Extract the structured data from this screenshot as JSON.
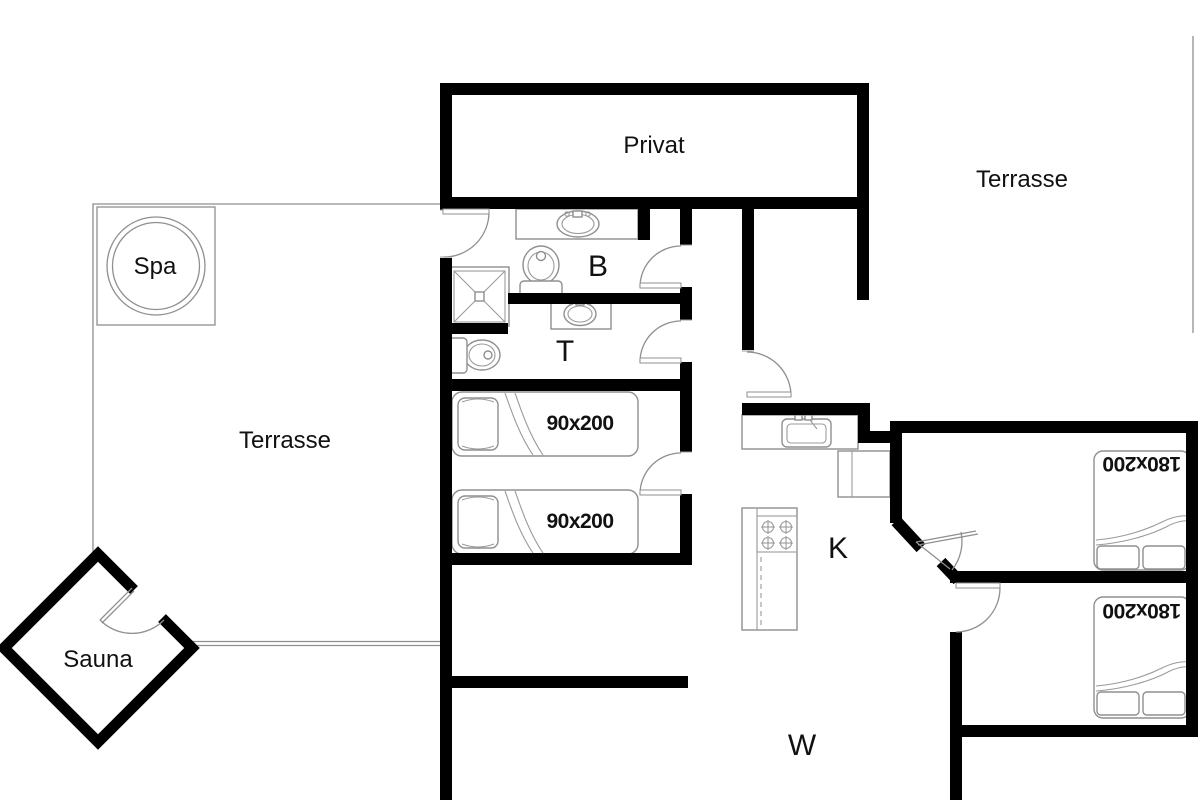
{
  "floorplan": {
    "rooms": {
      "privat": {
        "label": "Privat"
      },
      "terrace_top": {
        "label": "Terrasse"
      },
      "terrace_left": {
        "label": "Terrasse"
      },
      "spa": {
        "label": "Spa"
      },
      "sauna": {
        "label": "Sauna"
      },
      "bathroom": {
        "label": "B"
      },
      "toilet": {
        "label": "T"
      },
      "kitchen": {
        "label": "K"
      },
      "living_room": {
        "label": "W"
      }
    },
    "beds": {
      "single_1": {
        "label": "90x200"
      },
      "single_2": {
        "label": "90x200"
      },
      "double_1": {
        "label": "180x200"
      },
      "double_2": {
        "label": "180x200"
      }
    },
    "colors": {
      "wall": "#000000",
      "fixture_line": "#8f8f8f",
      "background": "#ffffff",
      "label_text": "#111111"
    }
  }
}
